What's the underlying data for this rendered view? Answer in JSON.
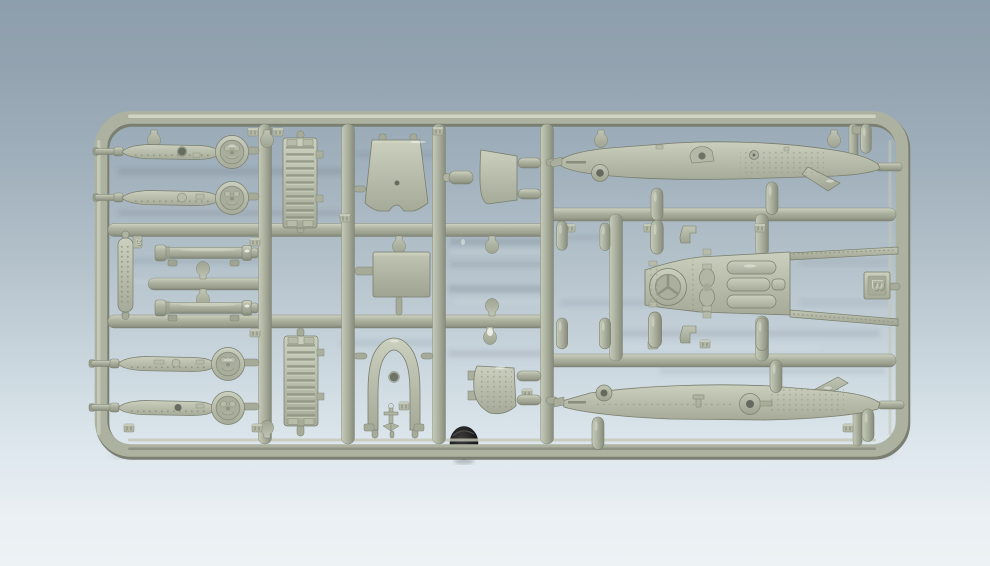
{
  "scene": {
    "type": "photograph",
    "subject": "grey-green injection-molded plastic model kit sprue (runner B) of a small warship, lying on a glossy blue-grey backdrop",
    "sprue_tag_letter": "B",
    "left_tag_number": "20",
    "support_object": "small black rubber disc under the bottom rail",
    "parts": [
      "superstructure-deck-with-gun-tub (x4, left column)",
      "ribbed-hatch-panel (x2, second column)",
      "bridge-front-trapezoid-panel",
      "flat-rectangular-panel",
      "bridge-arch-frame",
      "small-anchor",
      "textured-step-strip (tag 20)",
      "gun-barrel-cylinder (x2)",
      "small-cylinder-peg",
      "angled-side-panel",
      "riveted-transom-panel",
      "hull-side-upper (long, riveted, with rudder fin)",
      "hull-side-lower (long, riveted, with ring fitting)",
      "stern-deck-with-gun-tub-and-engine-hatches",
      "hull-gunwale-strips (x2, attached to stern deck)",
      "engine-room-grating-panel",
      "depth-charge-bullet-gates (many)",
      "sprue-letter-tag-B",
      "embossed-part-number-tabs (illegible)"
    ]
  },
  "colors": {
    "bg_top": "#8d9eac",
    "bg_bottom": "#edf2f5",
    "p_light": "#ced2c0",
    "p_mid": "#adb2a0",
    "p_mid2": "#9ba08e",
    "p_dark": "#7f8478",
    "p_line": "#7c816f",
    "p_texture": "#8d9281",
    "disc_black": "#141414"
  }
}
